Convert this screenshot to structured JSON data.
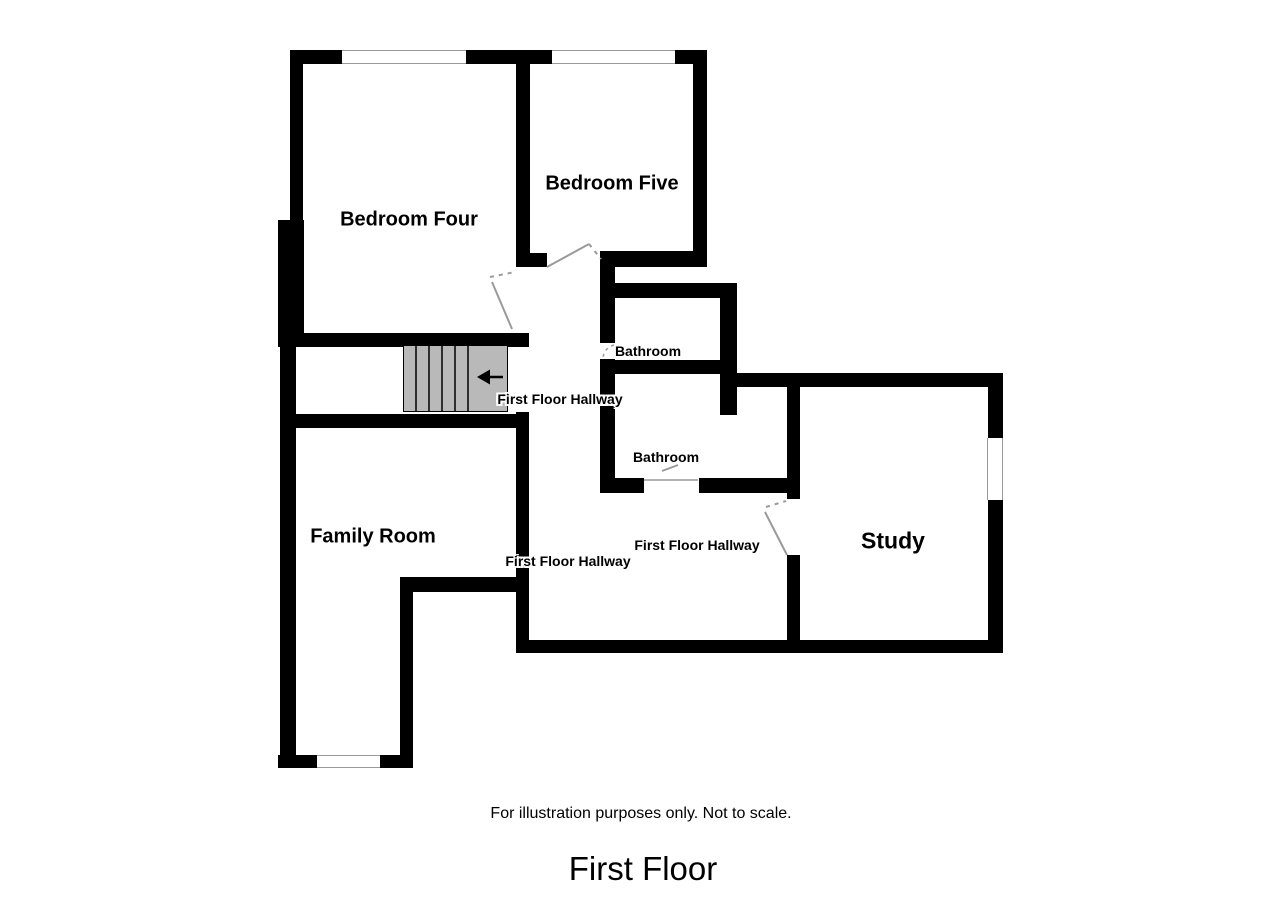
{
  "document": {
    "type": "floor-plan",
    "floor_title": "First Floor",
    "disclaimer": "For illustration purposes only. Not to scale."
  },
  "rooms": [
    {
      "id": "bedroom-four",
      "label": "Bedroom Four"
    },
    {
      "id": "bedroom-five",
      "label": "Bedroom Five"
    },
    {
      "id": "bathroom-upper",
      "label": "Bathroom"
    },
    {
      "id": "bathroom-lower",
      "label": "Bathroom"
    },
    {
      "id": "hallway-stairs",
      "label": "First Floor Hallway"
    },
    {
      "id": "hallway-left",
      "label": "First Floor Hallway"
    },
    {
      "id": "hallway-mid",
      "label": "First Floor Hallway"
    },
    {
      "id": "family-room",
      "label": "Family Room"
    },
    {
      "id": "study",
      "label": "Study"
    }
  ],
  "stairs": {
    "icon": "left-arrow-icon",
    "direction": "left",
    "steps": 6
  },
  "features": {
    "windows": 4,
    "door_swings": 4
  },
  "colors": {
    "wall": "#000000",
    "stairs_fill": "#b9b9b9",
    "door_line": "#9a9a9a",
    "background": "#ffffff",
    "text": "#000000"
  }
}
